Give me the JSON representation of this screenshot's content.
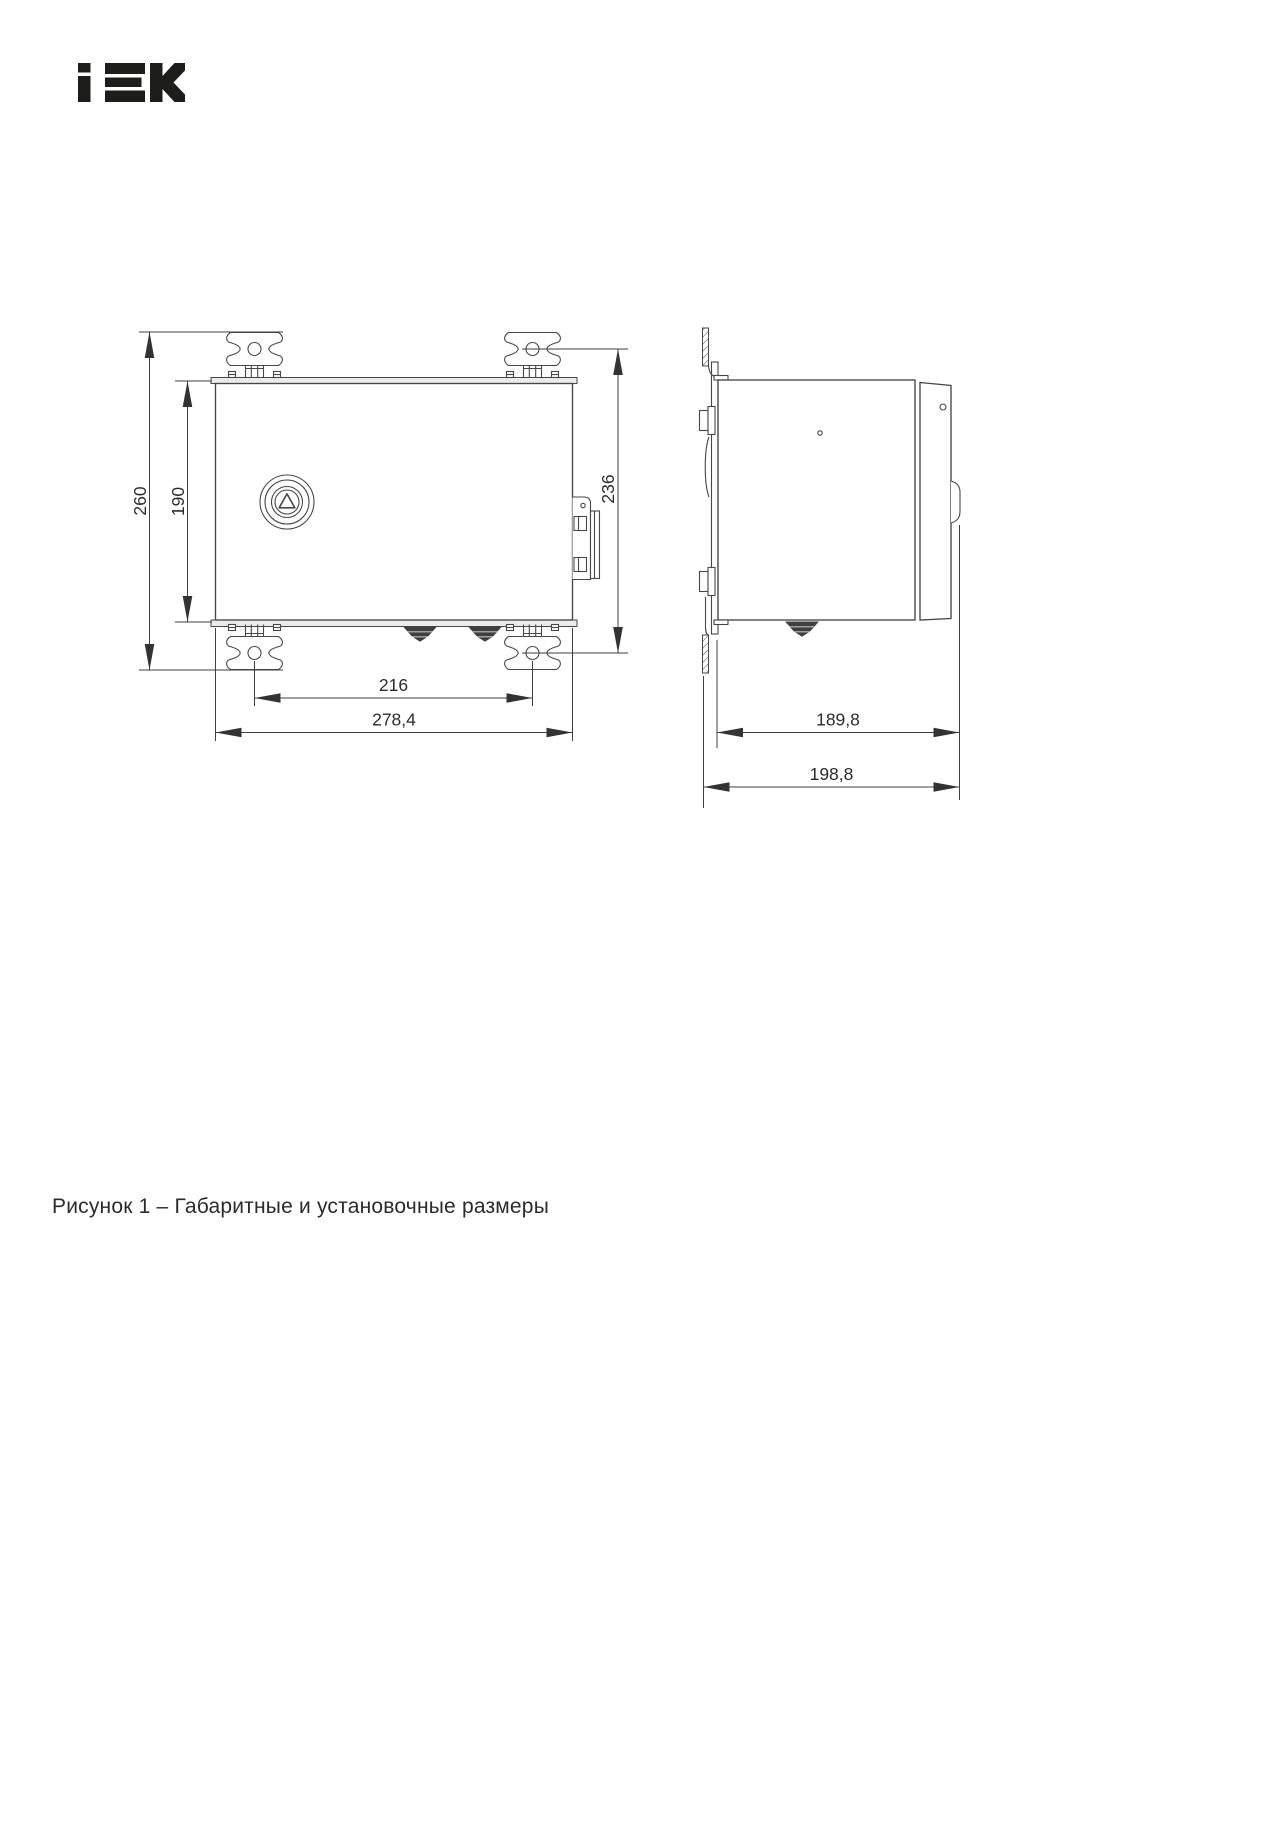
{
  "page": {
    "background": "#ffffff"
  },
  "logo": {
    "brand": "IEK",
    "color": "#1d1d1b"
  },
  "figure": {
    "caption": "Рисунок 1 – Габаритные и установочные размеры",
    "front_view": {
      "dimensions": {
        "overall_height_mm": "260",
        "body_height_mm": "190",
        "insulator_centers_vertical_mm": "236",
        "insulator_centers_horizontal_mm": "216",
        "overall_width_mm": "278,4"
      }
    },
    "side_view": {
      "dimensions": {
        "body_depth_mm": "189,8",
        "overall_depth_mm": "198,8"
      }
    }
  }
}
